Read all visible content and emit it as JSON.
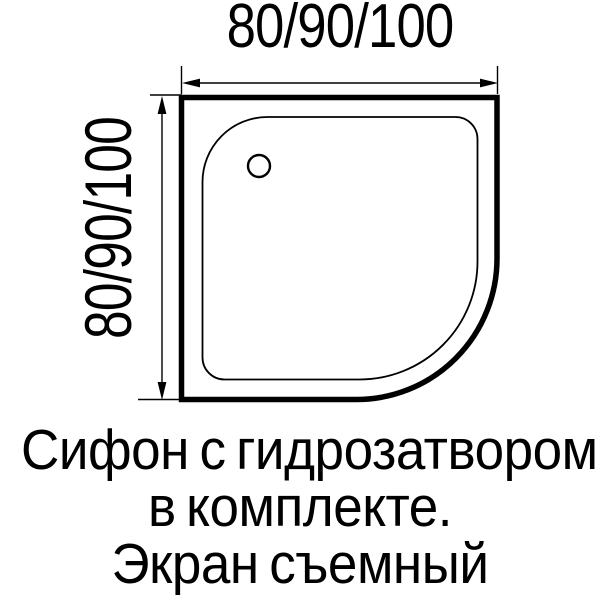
{
  "page": {
    "background_color": "#ffffff",
    "line_color": "#000000",
    "text_color": "#000000"
  },
  "diagram": {
    "type": "shower-tray-top-view",
    "width_dimension_label": "80/90/100",
    "height_dimension_label": "80/90/100",
    "features": [
      "tray-outer-outline",
      "tray-inner-outline",
      "drain-hole",
      "width-dimension-arrow",
      "height-dimension-arrow"
    ]
  },
  "caption": {
    "line1": "Сифон с гидрозатвором",
    "line2": "в комплекте.",
    "line3": "Экран съемный"
  }
}
